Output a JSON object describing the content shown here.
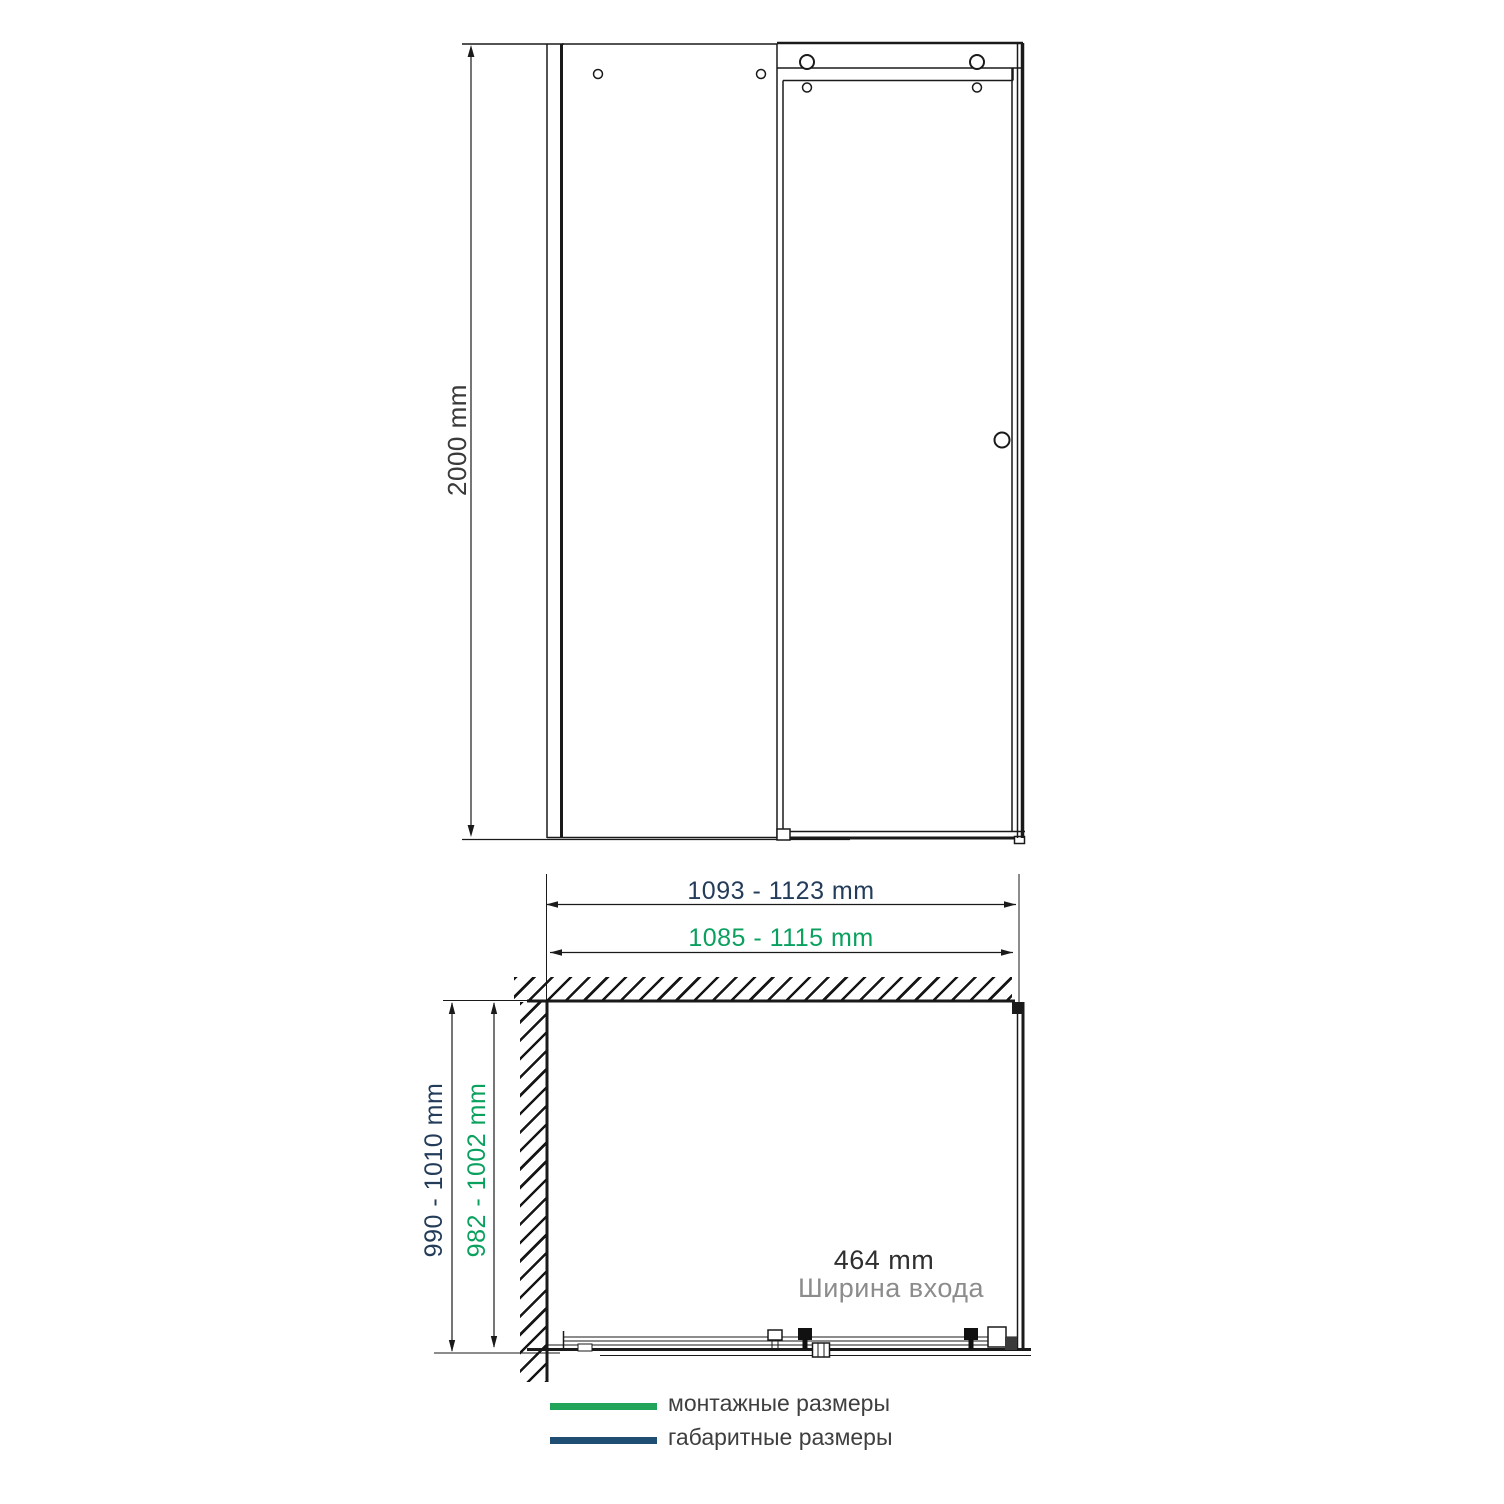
{
  "elevation": {
    "height_label": "2000 mm"
  },
  "plan": {
    "overall_width_label": "1093 - 1123 mm",
    "mounting_width_label": "1085 - 1115 mm",
    "overall_depth_label": "990 - 1010 mm",
    "mounting_depth_label": "982 - 1002 mm",
    "entrance": {
      "value": "464 mm",
      "caption": "Ширина входа"
    }
  },
  "legend": {
    "items": [
      {
        "label": "монтажные размеры",
        "meaning": "mounting dimensions",
        "color": "#23a45b"
      },
      {
        "label": "габаритные размеры",
        "meaning": "overall dimensions",
        "color": "#1f4e72"
      }
    ]
  },
  "colors": {
    "mounting_green_text": "#0aa05e",
    "overall_navy_text": "#233c59",
    "drawing_line": "#1a1a1a",
    "entrance_caption_gray": "#8c8c8c"
  }
}
